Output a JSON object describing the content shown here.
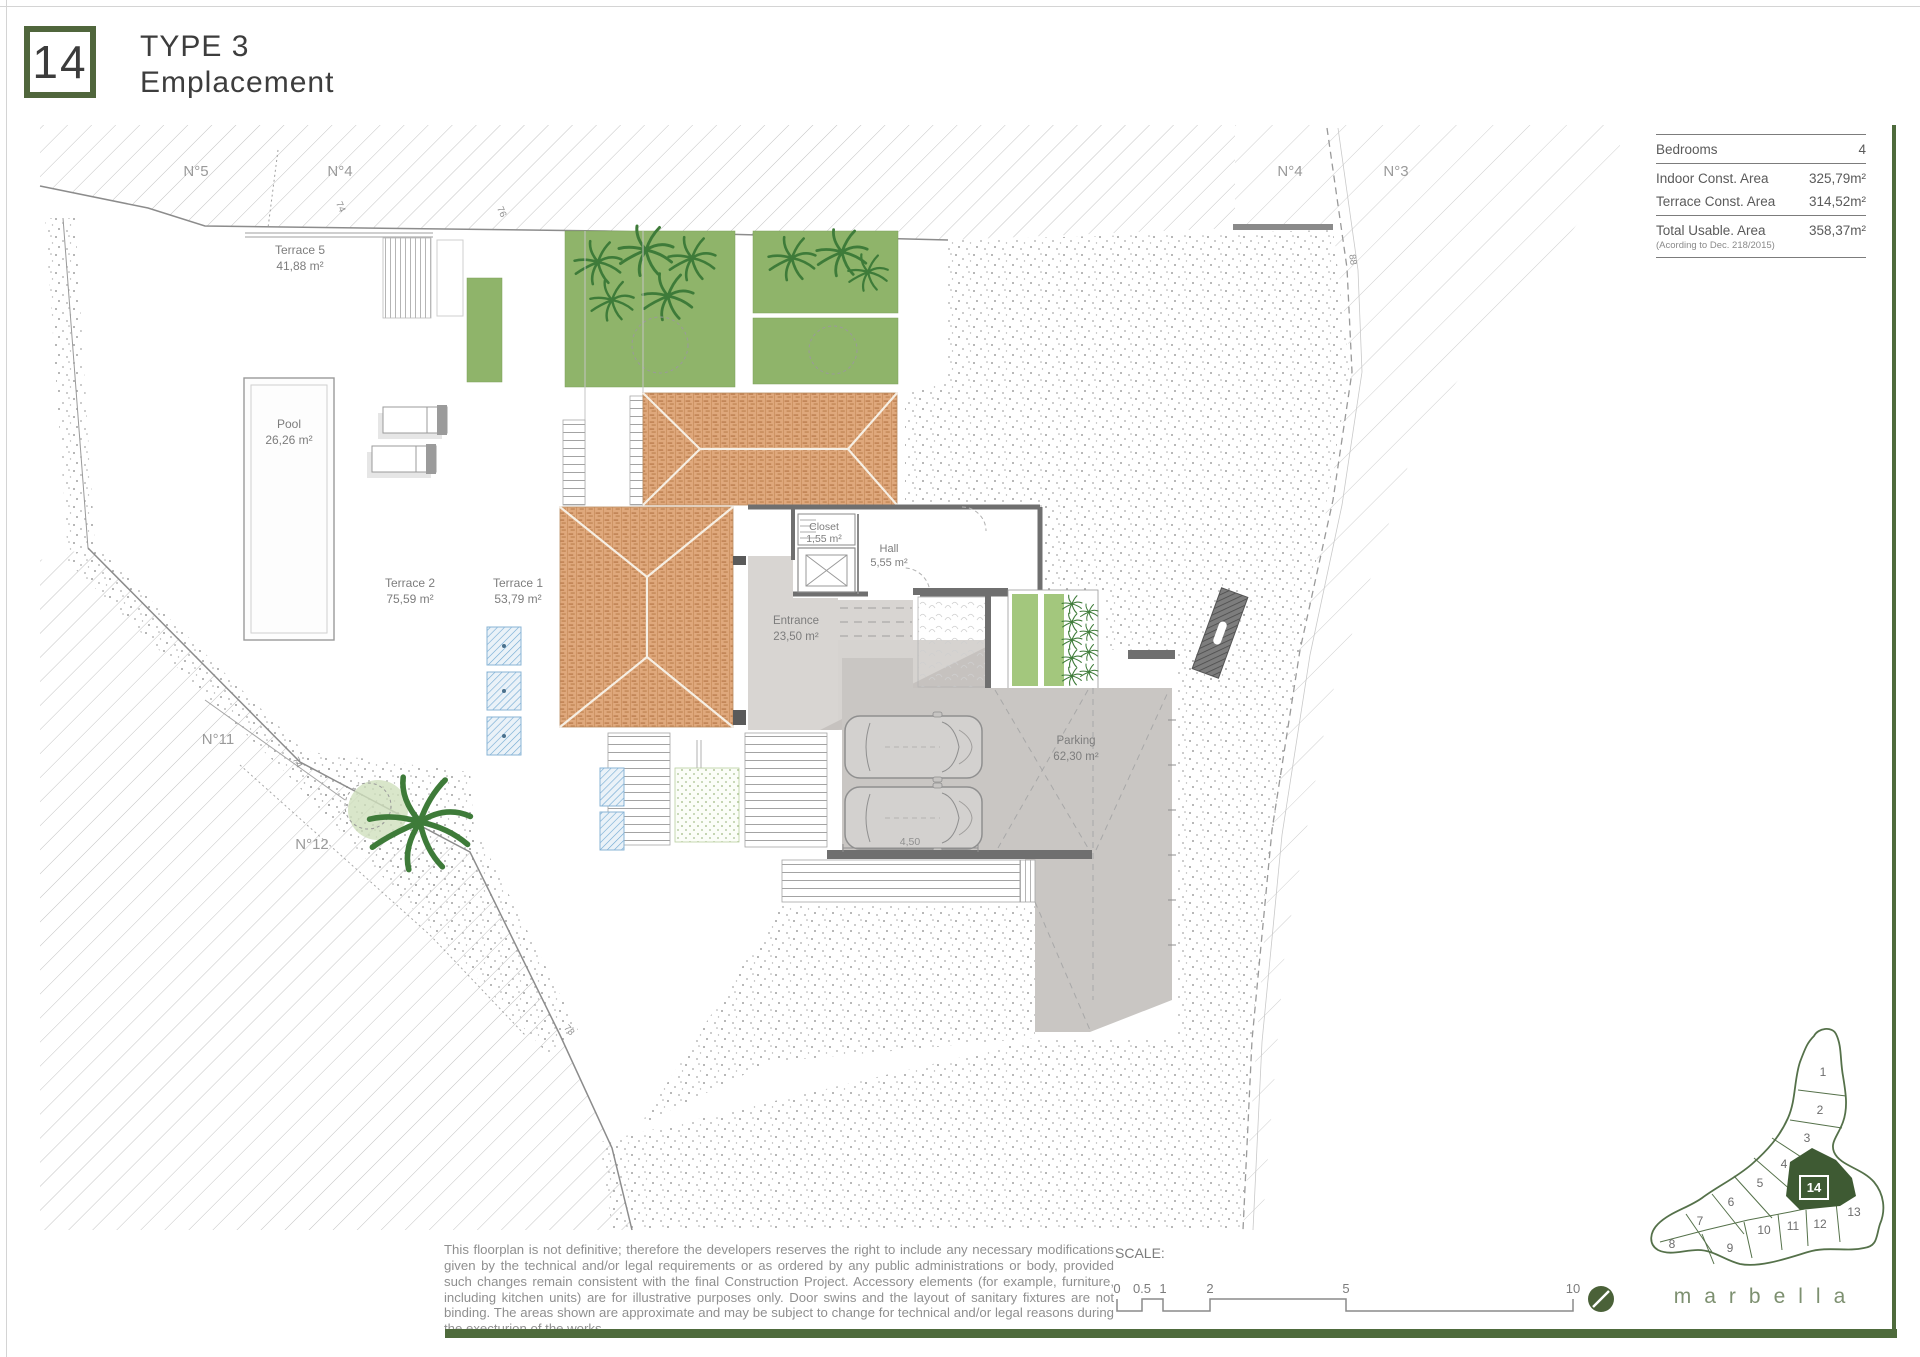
{
  "header": {
    "lot_number": "14",
    "type": "TYPE 3",
    "subtitle": "Emplacement"
  },
  "info_panel": {
    "bedrooms_label": "Bedrooms",
    "bedrooms_value": "4",
    "indoor_label": "Indoor Const. Area",
    "indoor_value": "325,79m²",
    "terrace_label": "Terrace Const. Area",
    "terrace_value": "314,52m²",
    "total_label": "Total Usable. Area",
    "total_note": "(Acording to Dec. 218/2015)",
    "total_value": "358,37m²"
  },
  "plan": {
    "plots": {
      "n5": "N°5",
      "n4_left": "N°4",
      "n4_right": "N°4",
      "n3": "N°3",
      "n11": "N°11",
      "n12": "N°12"
    },
    "rooms": {
      "terrace5": {
        "name": "Terrace 5",
        "area": "41,88 m²"
      },
      "pool": {
        "name": "Pool",
        "area": "26,26 m²"
      },
      "terrace2": {
        "name": "Terrace 2",
        "area": "75,59 m²"
      },
      "terrace1": {
        "name": "Terrace 1",
        "area": "53,79 m²"
      },
      "closet": {
        "name": "Closet",
        "area": "1,55 m²"
      },
      "hall": {
        "name": "Hall",
        "area": "5,55 m²"
      },
      "entrance": {
        "name": "Entrance",
        "area": "23,50 m²"
      },
      "parking": {
        "name": "Parking",
        "area": "62,30 m²"
      }
    },
    "dimensions": {
      "top_left": "74",
      "top_mid": "76",
      "right": "88",
      "left_lower": "74",
      "bottom": "78",
      "car_bay": "4,50"
    }
  },
  "disclaimer": "This floorplan is not definitive; therefore the developers reserves the right to include any necessary modifications given by the technical and/or legal requirements or as ordered by any public administrations or body, provided such changes remain consistent with the final Construction Project. Accessory elements (for example, furniture, including kitchen units) are for illustrative purposes only. Door swins and the layout of sanitary fixtures are not binding. The areas shown are approximate and may be subject to change for technical and/or legal reasons during the execturion of the works.",
  "scale_bar": {
    "label": "SCALE:",
    "ticks": [
      "0",
      "0.5",
      "1",
      "2",
      "5",
      "10"
    ]
  },
  "key_map": {
    "plots": [
      "1",
      "2",
      "3",
      "4",
      "5",
      "6",
      "7",
      "8",
      "9",
      "10",
      "11",
      "12",
      "13"
    ],
    "highlighted": "14",
    "brand": "marbella"
  },
  "colors": {
    "accent_green": "#4e6b3c",
    "roof": "#dfa87c",
    "parking": "#c9c6c3",
    "garden": "#8fb46a"
  }
}
